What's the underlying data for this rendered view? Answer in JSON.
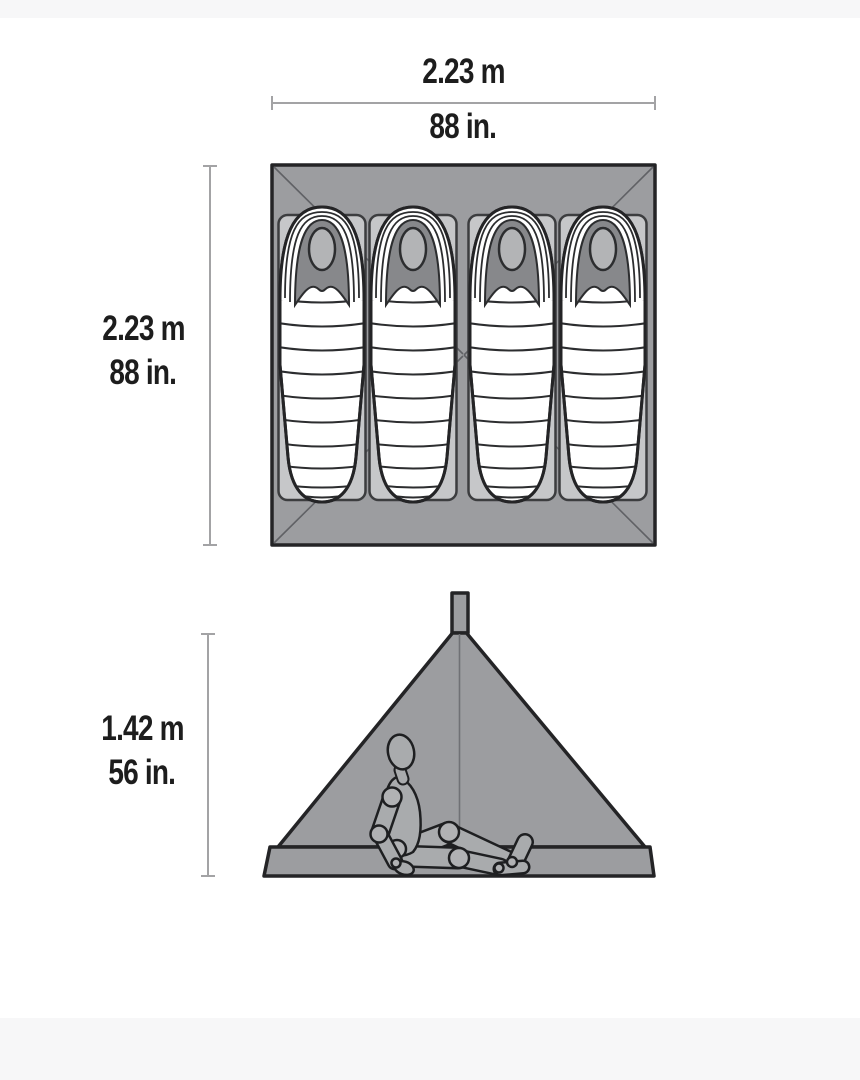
{
  "colors": {
    "band": "#f7f7f8",
    "tent_gray": "#9c9da0",
    "pad_gray": "#c6c7c9",
    "hood_dark": "#87888b",
    "face_gray": "#b3b4b6",
    "outline": "#242426",
    "dim_line": "#a3a3a5",
    "text": "#1d1d1d",
    "mannequin": "#a9abad"
  },
  "dimensions": {
    "plan_width": {
      "metric": "2.23 m",
      "imperial": "88 in."
    },
    "plan_depth": {
      "metric": "2.23 m",
      "imperial": "88 in."
    },
    "peak_height": {
      "metric": "1.42 m",
      "imperial": "56 in."
    }
  },
  "floor_plan": {
    "sleeping_bag_count": 4
  }
}
